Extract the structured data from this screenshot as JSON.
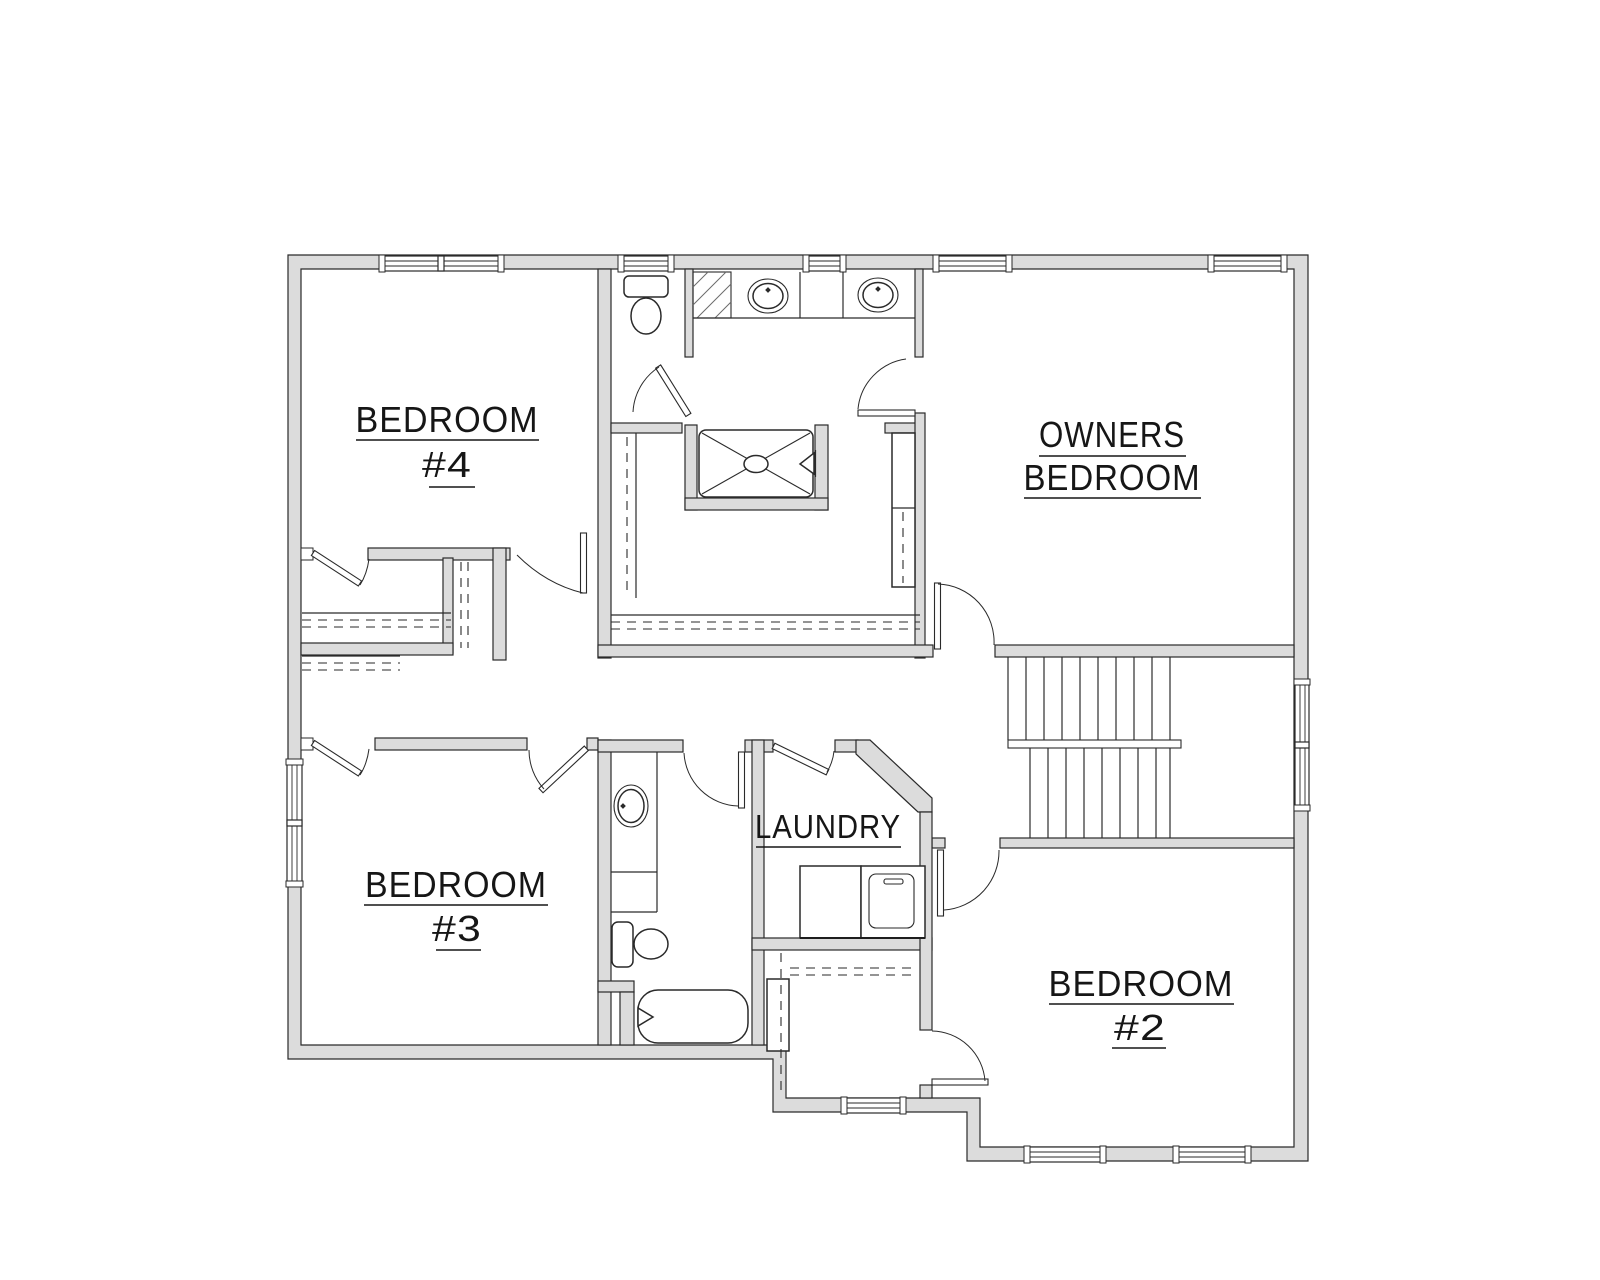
{
  "plan": {
    "title": "Second floor plan",
    "rooms": {
      "bedroom4": {
        "line1": "BEDROOM",
        "line2": "#4"
      },
      "owners": {
        "line1": "OWNERS",
        "line2": "BEDROOM"
      },
      "bedroom3": {
        "line1": "BEDROOM",
        "line2": "#3"
      },
      "bedroom2": {
        "line1": "BEDROOM",
        "line2": "#2"
      },
      "laundry": {
        "label": "LAUNDRY"
      }
    },
    "colors": {
      "wall_fill": "#dcdcdc",
      "line": "#2a2a2a",
      "text": "#161616",
      "background": "#ffffff"
    }
  }
}
